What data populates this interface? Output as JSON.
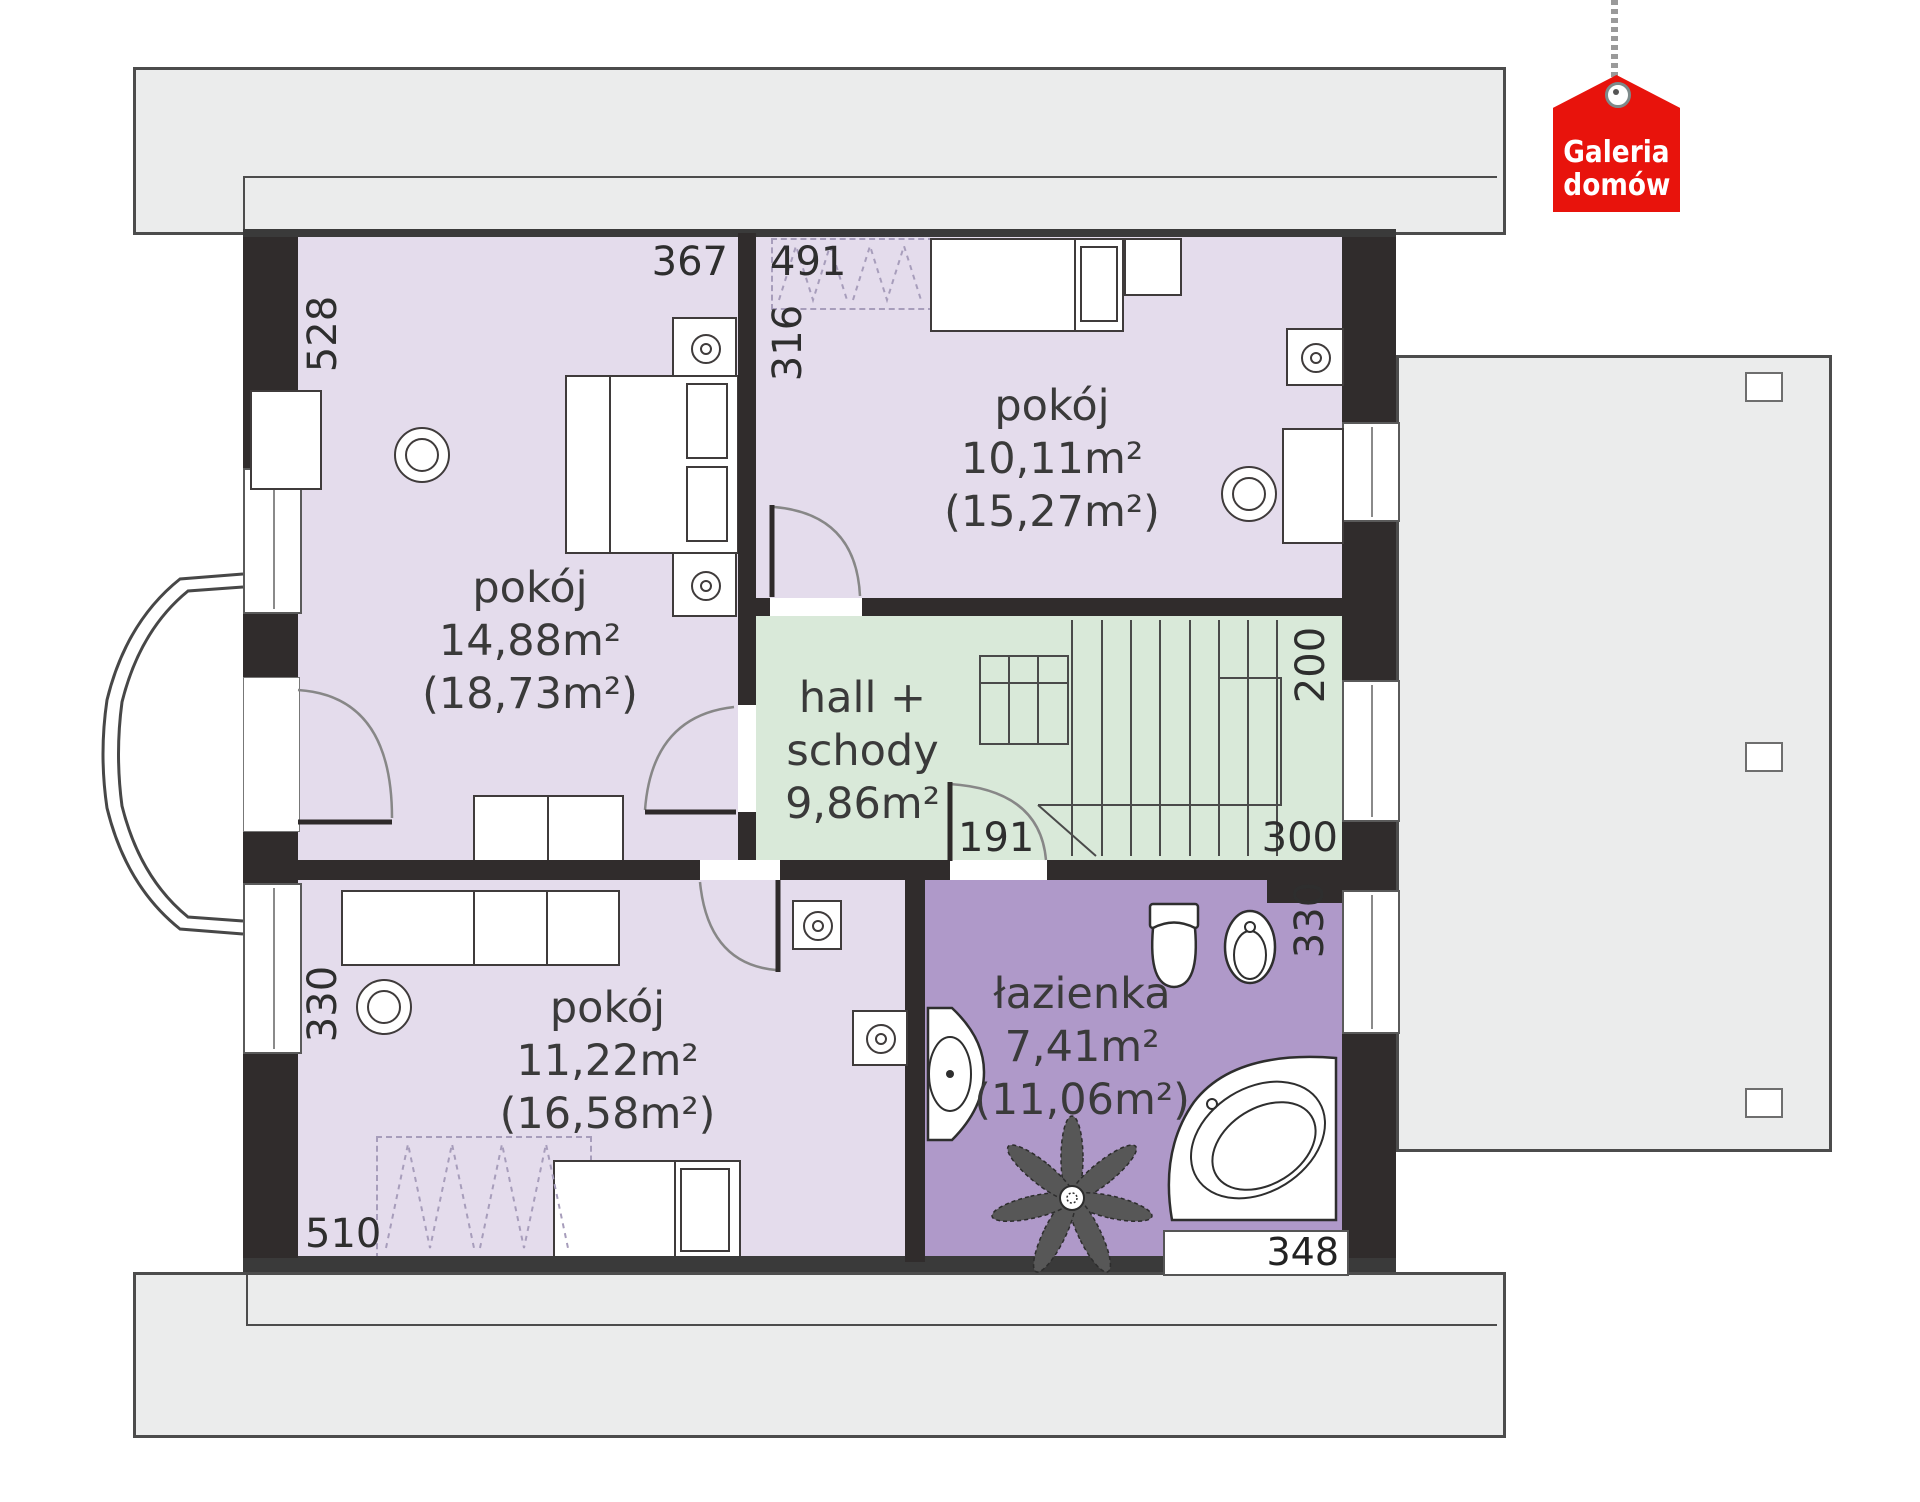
{
  "logo": {
    "line1": "Galeria",
    "line2": "domów"
  },
  "rooms": {
    "tl": {
      "name": "pokój",
      "area": "14,88m²",
      "gross": "(18,73m²)"
    },
    "tr": {
      "name": "pokój",
      "area": "10,11m²",
      "gross": "(15,27m²)"
    },
    "hall": {
      "line1": "hall +",
      "line2": "schody",
      "area": "9,86m²"
    },
    "bl": {
      "name": "pokój",
      "area": "11,22m²",
      "gross": "(16,58m²)"
    },
    "bath": {
      "name": "łazienka",
      "area": "7,41m²",
      "gross": "(11,06m²)"
    }
  },
  "dims": {
    "d528": "528",
    "d367": "367",
    "d491": "491",
    "d316": "316",
    "d200": "200",
    "d191": "191",
    "d300": "300",
    "d330r": "330",
    "d330l": "330",
    "d510": "510",
    "d348": "348"
  },
  "colors": {
    "room_fill": "#e4dcec",
    "hall_fill": "#d9e9d9",
    "bath_fill": "#af99c9",
    "wall": "#302c2c",
    "roof_fill": "#ebecec",
    "logo_red": "#e8130c"
  }
}
